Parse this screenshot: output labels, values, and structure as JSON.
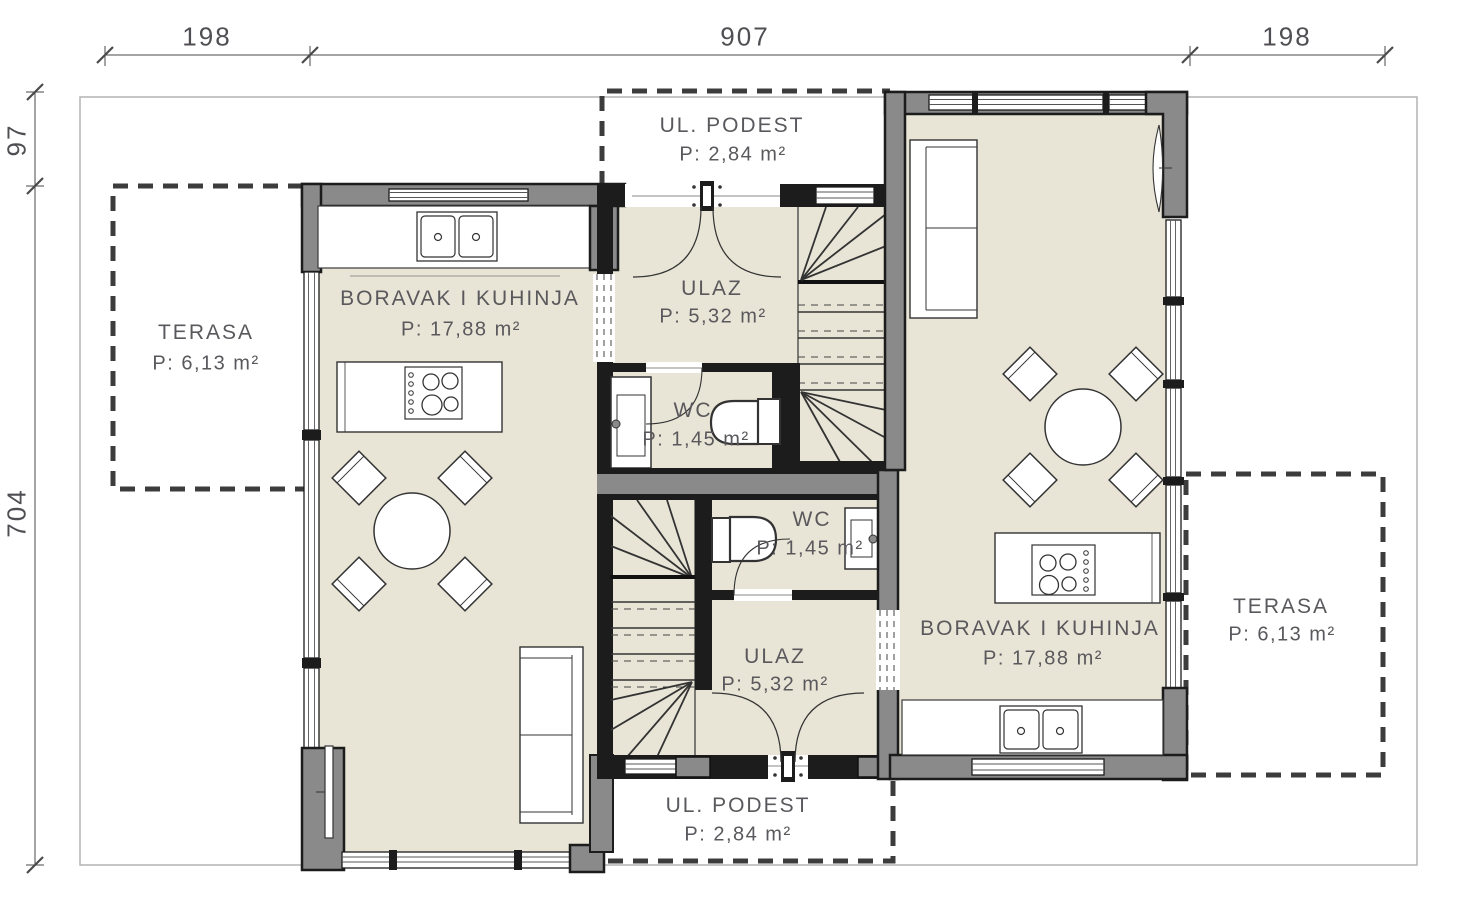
{
  "colors": {
    "floor": "#e8e4d6",
    "wall_gray": "#8a8a8a",
    "wall_dark": "#1c1c1c",
    "dashed_line": "#3c3c3c",
    "plot_boundary": "#b3b3b3",
    "text": "#5a585c"
  },
  "dimensions": {
    "top_left": "198",
    "top_middle": "907",
    "top_right": "198",
    "side_top": "97",
    "side_main": "704"
  },
  "rooms": {
    "terasa_left": {
      "name": "TERASA",
      "area": "P: 6,13 m²"
    },
    "boravak_left": {
      "name": "BORAVAK I KUHINJA",
      "area": "P: 17,88 m²"
    },
    "ul_podest_top": {
      "name": "UL. PODEST",
      "area": "P: 2,84 m²"
    },
    "ulaz_top": {
      "name": "ULAZ",
      "area": "P: 5,32 m²"
    },
    "wc_top": {
      "name": "WC",
      "area": "P: 1,45 m²"
    },
    "wc_bottom": {
      "name": "WC",
      "area": "P: 1,45 m²"
    },
    "ulaz_bottom": {
      "name": "ULAZ",
      "area": "P: 5,32 m²"
    },
    "ul_podest_bottom": {
      "name": "UL. PODEST",
      "area": "P: 2,84 m²"
    },
    "boravak_right": {
      "name": "BORAVAK I KUHINJA",
      "area": "P: 17,88 m²"
    },
    "terasa_right": {
      "name": "TERASA",
      "area": "P: 6,13 m²"
    }
  }
}
